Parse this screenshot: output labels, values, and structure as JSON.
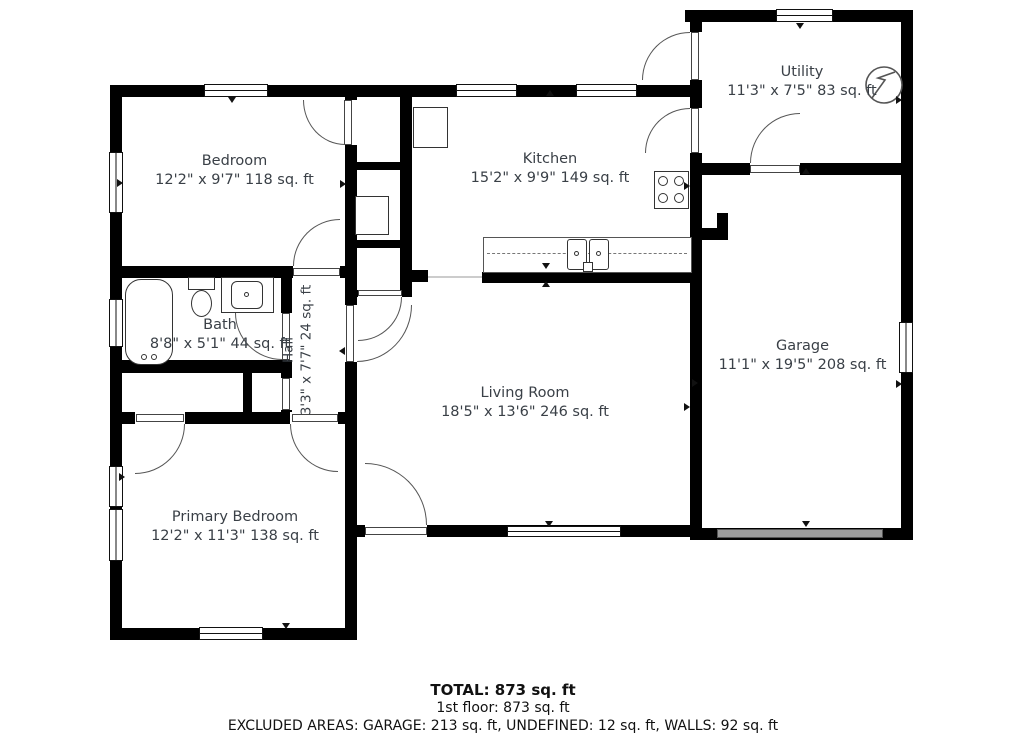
{
  "plan_title": "1st floor plan",
  "rooms": {
    "bedroom": {
      "name": "Bedroom",
      "dims": "12'2\" x 9'7\" 118 sq. ft"
    },
    "kitchen": {
      "name": "Kitchen",
      "dims": "15'2\" x 9'9\" 149 sq. ft"
    },
    "utility": {
      "name": "Utility",
      "dims": "11'3\" x 7'5\" 83 sq. ft"
    },
    "garage": {
      "name": "Garage",
      "dims": "11'1\" x 19'5\" 208 sq. ft"
    },
    "living_room": {
      "name": "Living Room",
      "dims": "18'5\" x 13'6\" 246 sq. ft"
    },
    "bath": {
      "name": "Bath",
      "dims": "8'8\" x 5'1\" 44 sq. ft"
    },
    "hall": {
      "name": "Hall",
      "dims": "3'3\" x 7'7\" 24 sq. ft"
    },
    "primary_bedroom": {
      "name": "Primary Bedroom",
      "dims": "12'2\" x 11'3\" 138 sq. ft"
    }
  },
  "footer": {
    "total": "TOTAL: 873 sq. ft",
    "floor1": "1st floor: 873 sq. ft",
    "excluded": "EXCLUDED AREAS: GARAGE: 213 sq. ft, UNDEFINED: 12 sq. ft, WALLS: 92 sq. ft"
  },
  "colors": {
    "wall": "#000000",
    "label_text": "#3a4047",
    "garage_door": "#9b9b9b"
  }
}
